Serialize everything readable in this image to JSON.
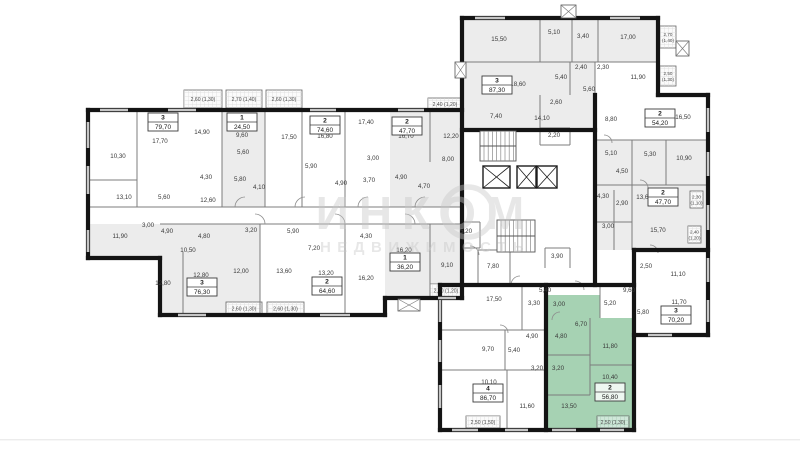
{
  "watermark": {
    "line1": "ИНКОМ",
    "line2": "НЕДВИЖИМОСТЬ"
  },
  "colors": {
    "highlight_fill": "#a6d2b3",
    "highlight_balcony": "#cfe7d9",
    "shade_fill": "#ececec",
    "wall": "#141414",
    "thin_wall": "#7c7c7c",
    "window": "#c6c6c6",
    "label": "#3a3a3a",
    "watermark": "#c7c7c7"
  },
  "apartments": [
    {
      "id": "apt-79-70",
      "rooms_count": "3",
      "area": "79,70",
      "x": 163,
      "y": 122,
      "highlighted": false
    },
    {
      "id": "apt-24-50",
      "rooms_count": "1",
      "area": "24,50",
      "x": 242,
      "y": 122,
      "highlighted": false
    },
    {
      "id": "apt-74-60",
      "rooms_count": "2",
      "area": "74,60",
      "x": 325,
      "y": 125,
      "highlighted": false
    },
    {
      "id": "apt-47-70-left",
      "rooms_count": "2",
      "area": "47,70",
      "x": 407,
      "y": 126,
      "highlighted": false
    },
    {
      "id": "apt-87-30",
      "rooms_count": "3",
      "area": "87,30",
      "x": 497,
      "y": 85,
      "highlighted": false
    },
    {
      "id": "apt-54-20",
      "rooms_count": "2",
      "area": "54,20",
      "x": 660,
      "y": 118,
      "highlighted": false
    },
    {
      "id": "apt-47-70-right",
      "rooms_count": "2",
      "area": "47,70",
      "x": 663,
      "y": 197,
      "highlighted": false
    },
    {
      "id": "apt-76-30",
      "rooms_count": "3",
      "area": "76,30",
      "x": 202,
      "y": 287,
      "highlighted": false
    },
    {
      "id": "apt-64-60",
      "rooms_count": "2",
      "area": "64,60",
      "x": 327,
      "y": 286,
      "highlighted": false
    },
    {
      "id": "apt-36-20",
      "rooms_count": "1",
      "area": "36,20",
      "x": 405,
      "y": 262,
      "highlighted": false
    },
    {
      "id": "apt-86-70",
      "rooms_count": "4",
      "area": "86,70",
      "x": 488,
      "y": 393,
      "highlighted": false
    },
    {
      "id": "apt-56-80",
      "rooms_count": "2",
      "area": "56,80",
      "x": 610,
      "y": 392,
      "highlighted": true
    },
    {
      "id": "apt-70-20",
      "rooms_count": "3",
      "area": "70,20",
      "x": 676,
      "y": 315,
      "highlighted": false
    }
  ],
  "room_labels": [
    [
      "17,70",
      160,
      143
    ],
    [
      "10,30",
      118,
      158
    ],
    [
      "13,10",
      124,
      199
    ],
    [
      "5,60",
      164,
      199
    ],
    [
      "14,90",
      202,
      134
    ],
    [
      "4,30",
      206,
      179
    ],
    [
      "12,60",
      208,
      202
    ],
    [
      "9,60",
      242,
      137
    ],
    [
      "5,60",
      243,
      154
    ],
    [
      "5,80",
      240,
      181
    ],
    [
      "4,10",
      259,
      189
    ],
    [
      "17,50",
      289,
      139
    ],
    [
      "16,80",
      325,
      138
    ],
    [
      "5,90",
      311,
      168
    ],
    [
      "4,90",
      341,
      185
    ],
    [
      "17,40",
      366,
      124
    ],
    [
      "3,00",
      373,
      160
    ],
    [
      "3,70",
      369,
      182
    ],
    [
      "16,70",
      406,
      138
    ],
    [
      "4,90",
      401,
      179
    ],
    [
      "4,70",
      424,
      188
    ],
    [
      "12,20",
      451,
      138
    ],
    [
      "8,00",
      448,
      161
    ],
    [
      "11,90",
      120,
      238
    ],
    [
      "3,00",
      148,
      227
    ],
    [
      "4,90",
      167,
      233
    ],
    [
      "4,80",
      204,
      238
    ],
    [
      "10,50",
      188,
      252
    ],
    [
      "12,80",
      163,
      285
    ],
    [
      "12,80",
      201,
      277
    ],
    [
      "12,00",
      241,
      273
    ],
    [
      "3,20",
      251,
      232
    ],
    [
      "5,90",
      293,
      233
    ],
    [
      "7,20",
      314,
      250
    ],
    [
      "4,30",
      366,
      238
    ],
    [
      "13,60",
      284,
      273
    ],
    [
      "13,20",
      326,
      275
    ],
    [
      "16,20",
      366,
      280
    ],
    [
      "16,20",
      404,
      252
    ],
    [
      "9,10",
      447,
      267
    ],
    [
      "5,20",
      466,
      233
    ],
    [
      "7,80",
      493,
      268
    ],
    [
      "2,20",
      554,
      137
    ],
    [
      "3,90",
      557,
      258
    ],
    [
      "15,50",
      499,
      41
    ],
    [
      "5,10",
      554,
      34
    ],
    [
      "3,40",
      583,
      38
    ],
    [
      "17,00",
      628,
      39
    ],
    [
      "18,60",
      518,
      86
    ],
    [
      "5,40",
      561,
      79
    ],
    [
      "2,40",
      581,
      69
    ],
    [
      "2,30",
      603,
      69
    ],
    [
      "5,60",
      589,
      91
    ],
    [
      "2,60",
      556,
      104
    ],
    [
      "7,40",
      496,
      118
    ],
    [
      "14,10",
      542,
      120
    ],
    [
      "8,80",
      611,
      121
    ],
    [
      "11,90",
      638,
      79
    ],
    [
      "16,50",
      683,
      119
    ],
    [
      "5,10",
      611,
      155
    ],
    [
      "5,30",
      650,
      156
    ],
    [
      "10,90",
      684,
      160
    ],
    [
      "4,50",
      622,
      173
    ],
    [
      "4,30",
      603,
      198
    ],
    [
      "2,90",
      622,
      205
    ],
    [
      "13,60",
      644,
      199
    ],
    [
      "3,00",
      608,
      228
    ],
    [
      "15,70",
      658,
      232
    ],
    [
      "2,50",
      646,
      268
    ],
    [
      "11,10",
      678,
      276
    ],
    [
      "11,70",
      679,
      304
    ],
    [
      "5,80",
      643,
      314
    ],
    [
      "17,50",
      494,
      301
    ],
    [
      "3,30",
      534,
      305
    ],
    [
      "9,70",
      488,
      351
    ],
    [
      "5,40",
      514,
      352
    ],
    [
      "4,90",
      532,
      338
    ],
    [
      "3,20",
      537,
      370
    ],
    [
      "10,10",
      489,
      384
    ],
    [
      "11,60",
      527,
      408
    ],
    [
      "5,40",
      545,
      292
    ],
    [
      "9,60",
      629,
      292
    ],
    [
      "3,00",
      559,
      306
    ],
    [
      "5,20",
      610,
      305
    ],
    [
      "6,70",
      581,
      326
    ],
    [
      "4,80",
      561,
      338
    ],
    [
      "11,80",
      610,
      348
    ],
    [
      "3,20",
      558,
      370
    ],
    [
      "10,40",
      610,
      379
    ],
    [
      "13,50",
      569,
      408
    ]
  ],
  "balconies": [
    {
      "label": "2,60 (1,30)",
      "x": 184,
      "y": 90,
      "w": 38,
      "h": 18,
      "orient": "h",
      "green": false
    },
    {
      "label": "2,70 (1,40)",
      "x": 226,
      "y": 90,
      "w": 36,
      "h": 18,
      "orient": "h",
      "green": false
    },
    {
      "label": "2,60 (1,30)",
      "x": 266,
      "y": 90,
      "w": 36,
      "h": 18,
      "orient": "h",
      "green": false
    },
    {
      "label": "2,40 (1,20)",
      "x": 428,
      "y": 98,
      "w": 34,
      "h": 12,
      "orient": "h",
      "green": false
    },
    {
      "label": "2,60 (1,30)",
      "x": 226,
      "y": 302,
      "w": 36,
      "h": 13,
      "orient": "h",
      "green": false
    },
    {
      "label": "2,60 (1,30)",
      "x": 267,
      "y": 302,
      "w": 37,
      "h": 13,
      "orient": "h",
      "green": false
    },
    {
      "label": "2,40 (1,20)",
      "x": 430,
      "y": 284,
      "w": 32,
      "h": 13,
      "orient": "h",
      "green": false
    },
    {
      "label": "2,70 (1,40)",
      "x": 660,
      "y": 26,
      "w": 16,
      "h": 22,
      "orient": "v",
      "green": false
    },
    {
      "label": "2,50 (1,30)",
      "x": 660,
      "y": 66,
      "w": 16,
      "h": 20,
      "orient": "v",
      "green": false
    },
    {
      "label": "2,30 (1,10)",
      "x": 690,
      "y": 191,
      "w": 13,
      "h": 17,
      "orient": "v",
      "green": false
    },
    {
      "label": "2,40 (1,20)",
      "x": 688,
      "y": 226,
      "w": 13,
      "h": 17,
      "orient": "v",
      "green": false
    },
    {
      "label": "2,50 (1,50)",
      "x": 466,
      "y": 416,
      "w": 34,
      "h": 12,
      "orient": "h",
      "green": false
    },
    {
      "label": "2,50 (1,30)",
      "x": 597,
      "y": 416,
      "w": 32,
      "h": 12,
      "orient": "h",
      "green": true
    }
  ]
}
